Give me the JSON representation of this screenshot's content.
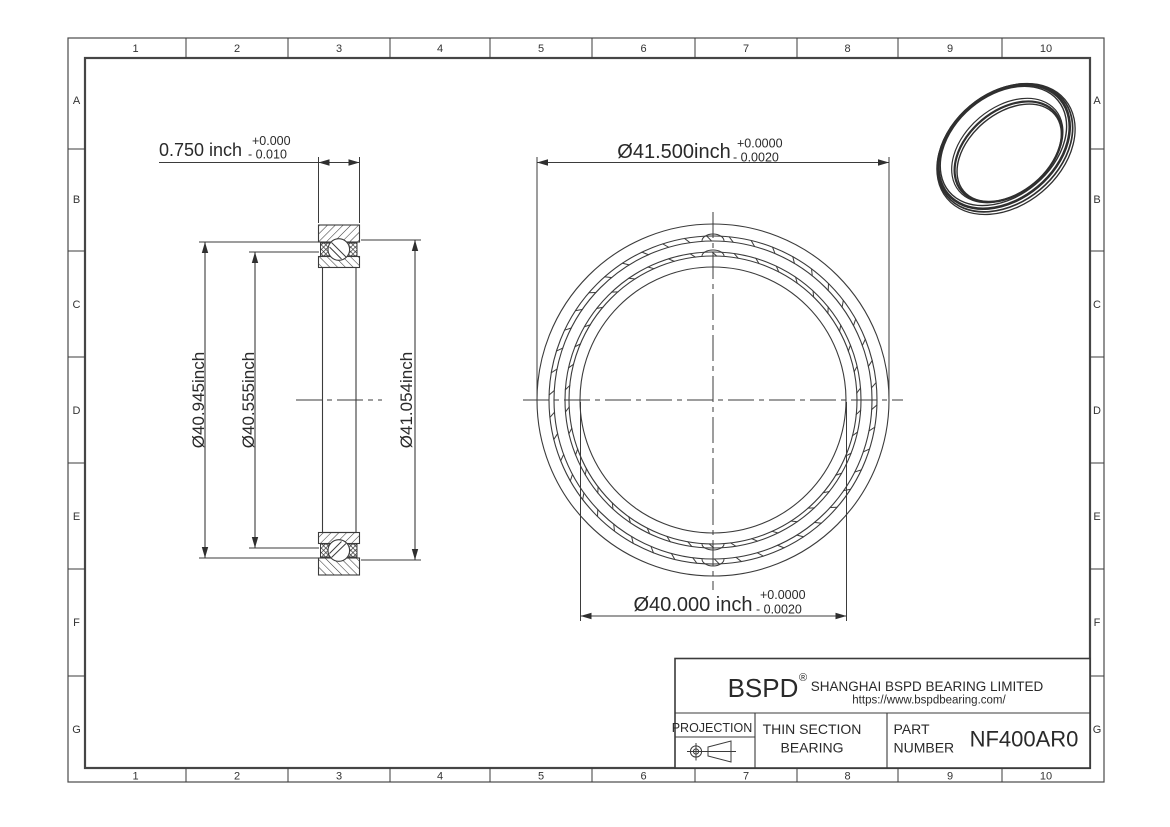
{
  "sheet": {
    "grid_columns": [
      "1",
      "2",
      "3",
      "4",
      "5",
      "6",
      "7",
      "8",
      "9",
      "10"
    ],
    "grid_rows": [
      "A",
      "B",
      "C",
      "D",
      "E",
      "F",
      "G"
    ]
  },
  "section_view": {
    "width_dim": {
      "value": "0.750 inch",
      "tol_plus": "+0.000",
      "tol_minus": "- 0.010"
    },
    "diameter_dims": [
      "Ø40.945inch",
      "Ø40.555inch",
      "Ø41.054inch"
    ]
  },
  "front_view": {
    "od_dim": {
      "value": "Ø41.500inch",
      "tol_plus": "+0.0000",
      "tol_minus": "- 0.0020"
    },
    "bore_dim": {
      "value": "Ø40.000 inch",
      "tol_plus": "+0.0000",
      "tol_minus": "- 0.0020"
    }
  },
  "title_block": {
    "logo": "BSPD",
    "logo_mark": "®",
    "company": "SHANGHAI BSPD BEARING LIMITED",
    "website": "https://www.bspdbearing.com/",
    "projection_label": "PROJECTION",
    "product_line1": "THIN SECTION",
    "product_line2": "BEARING",
    "part_label_line1": "PART",
    "part_label_line2": "NUMBER",
    "part_number": "NF400AR0"
  },
  "colors": {
    "line": "#3b3b3b",
    "text": "#2a2a2a"
  }
}
